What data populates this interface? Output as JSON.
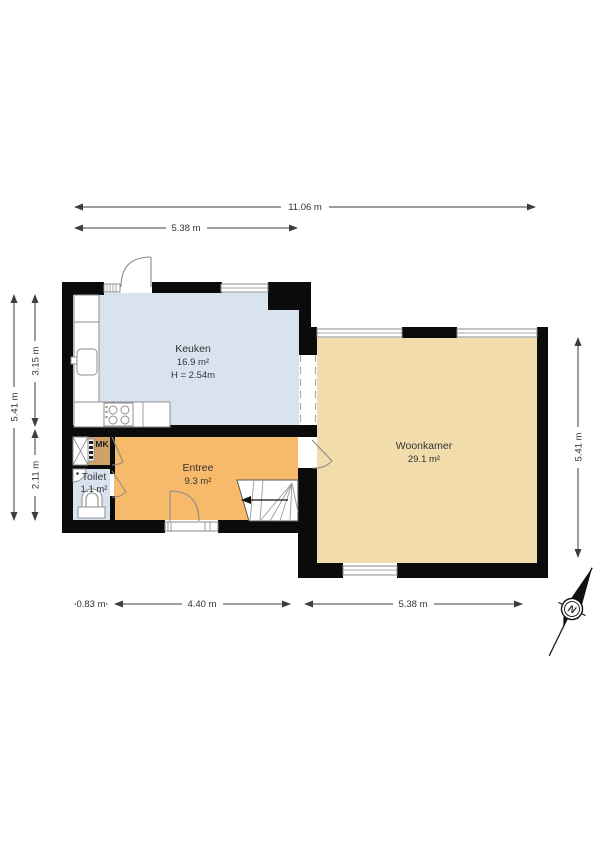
{
  "colors": {
    "kitchen": "#d9e3f0",
    "toilet": "#d9e3f0",
    "entree": "#f7ba6b",
    "woonkamer": "#f2dcab",
    "mk": "#d0a268",
    "wall": "#0b0b0b"
  },
  "rooms": {
    "keuken": {
      "name": "Keuken",
      "area": "16.9 m²",
      "height": "H = 2.54m"
    },
    "entree": {
      "name": "Entree",
      "area": "9.3 m²"
    },
    "toilet": {
      "name": "Toilet",
      "area": "1.1 m²"
    },
    "woonkamer": {
      "name": "Woonkamer",
      "area": "29.1 m²"
    },
    "mk": {
      "name": "MK"
    }
  },
  "dimensions": {
    "top_total": "11.06 m",
    "top_left": "5.38 m",
    "left_total": "5.41 m",
    "left_upper": "3.15 m",
    "left_lower": "2.11 m",
    "right_total": "5.41 m",
    "bottom_left": "0.83 m",
    "bottom_mid": "4.40 m",
    "bottom_right": "5.38 m"
  },
  "compass": {
    "north": "N"
  }
}
